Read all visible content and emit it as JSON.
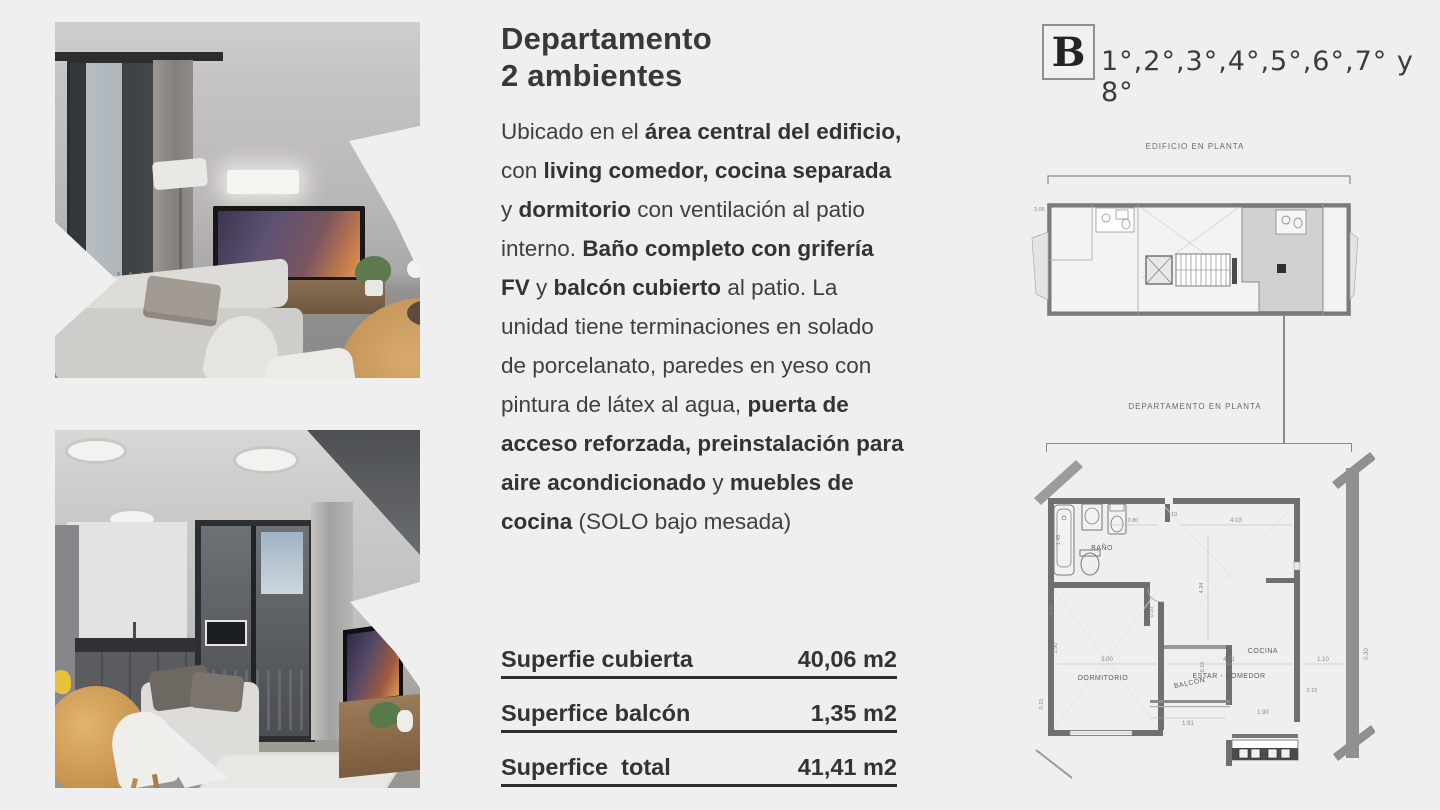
{
  "colors": {
    "background": "#efeff0",
    "text": "#3b3b3b",
    "plan_wall": "#6f6f6f",
    "plan_line": "#8a8a8a",
    "unit_highlight": "#c9c9c9"
  },
  "listing": {
    "title_line1": "Departamento",
    "title_line2": "2 ambientes",
    "description": [
      {
        "t": "Ubicado en el ",
        "b": 0
      },
      {
        "t": "área central del edificio,",
        "b": 1
      },
      {
        "t": " con ",
        "b": 0
      },
      {
        "t": "living comedor, cocina separada",
        "b": 1
      },
      {
        "t": " y ",
        "b": 0
      },
      {
        "t": "dormitorio",
        "b": 1
      },
      {
        "t": " con ventilación al patio interno. ",
        "b": 0
      },
      {
        "t": "Baño completo con grifería FV",
        "b": 1
      },
      {
        "t": " y ",
        "b": 0
      },
      {
        "t": "balcón cubierto",
        "b": 1
      },
      {
        "t": " al patio. La unidad tiene terminaciones en solado de porcelanato, paredes en yeso con pintura de látex al agua, ",
        "b": 0
      },
      {
        "t": "puerta de acceso reforzada, preinstalación para aire acondicionado",
        "b": 1
      },
      {
        "t": " y ",
        "b": 0
      },
      {
        "t": "muebles de cocina",
        "b": 1
      },
      {
        "t": " (SOLO bajo mesada)",
        "b": 0
      }
    ]
  },
  "surface_table": {
    "rows": [
      {
        "label": "Superfie cubierta",
        "value": "40,06 m2"
      },
      {
        "label": "Superfice balcón",
        "value": "1,35 m2"
      },
      {
        "label": "Superfice  total",
        "value": "41,41 m2"
      }
    ]
  },
  "unit": {
    "letter": "B",
    "floors": "1°,2°,3°,4°,5°,6°,7° y 8°"
  },
  "plans": {
    "building_label": "EDIFICIO EN PLANTA",
    "apartment_label": "DEPARTAMENTO EN PLANTA",
    "building_dim": "3.06",
    "rooms": {
      "bano": "BAÑO",
      "dormitorio": "DORMITORIO",
      "estar": "ESTAR - COMEDOR",
      "cocina": "COCINA",
      "balcon": "BALCÓN"
    },
    "dims": {
      "d080": "0.80",
      "d010": "0.10",
      "d403": "4.03",
      "d145": "1.45",
      "d040": "0.40",
      "d300": "3.00",
      "d401": "4.01",
      "d110": "1.10",
      "d030": "0.30",
      "d290": "2.90",
      "d434": "4.34",
      "d015": "0.15",
      "d191": "1.91",
      "d190": "1.90"
    }
  }
}
